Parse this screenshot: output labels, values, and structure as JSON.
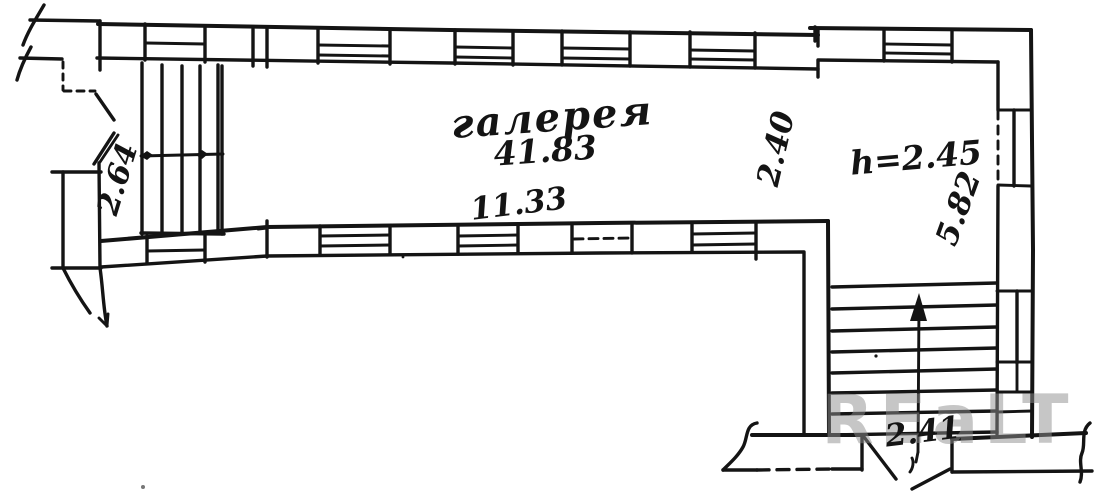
{
  "scan": {
    "paper_color": "#ffffff",
    "ink_color": "#141414",
    "labels": {
      "room_name": "галерея",
      "room_area": "41.83",
      "gallery_length": "11.33",
      "gallery_width": "2.40",
      "height_note": "h=2.45",
      "side_room_depth": "5.82",
      "stair_width": "2.41",
      "left_stair_width": "2.64"
    },
    "watermark": {
      "text": "REaLT",
      "color": "#8f8f8f"
    }
  }
}
